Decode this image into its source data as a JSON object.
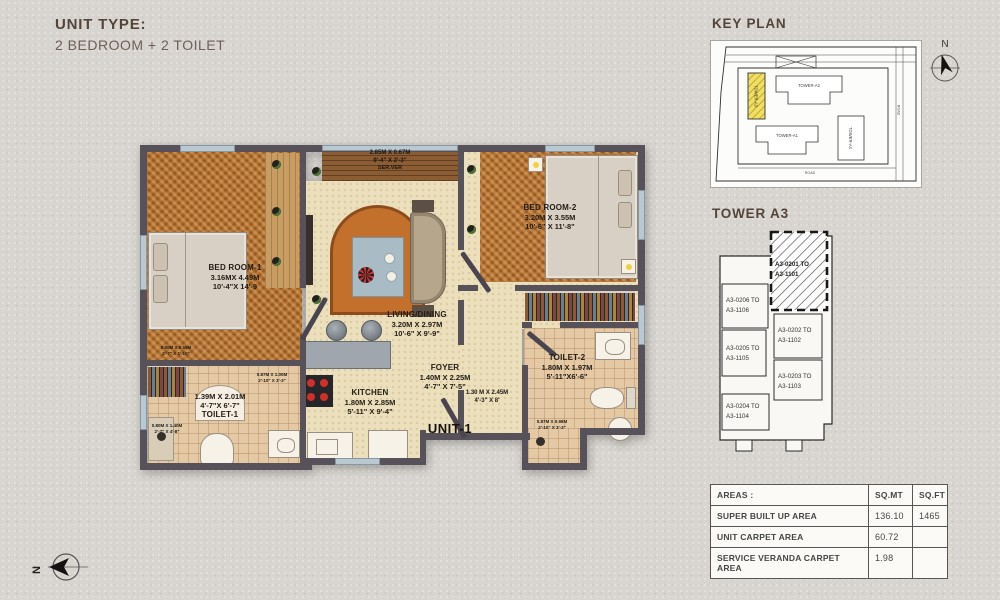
{
  "header": {
    "title": "UNIT TYPE:",
    "subtitle": "2 BEDROOM + 2 TOILET"
  },
  "plan": {
    "unit_label": "UNIT-1",
    "bedroom1": {
      "name": "BED ROOM-1",
      "m": "3.16MX 4.49M",
      "ft": "10'-4\"X 14'-9"
    },
    "bedroom2": {
      "name": "BED ROOM-2",
      "m": "3.20M X 3.55M",
      "ft": "10'-6\" X 11'-8\""
    },
    "living": {
      "name": "LIVING/DINING",
      "m": "3.20M X 2.97M",
      "ft": "10'-6\" X 9'-9\""
    },
    "foyer": {
      "name": "FOYER",
      "m": "1.40M X 2.25M",
      "ft": "4'-7\" X 7'-5\""
    },
    "kitchen": {
      "name": "KITCHEN",
      "m": "1.80M X 2.85M",
      "ft": "5'-11\" X 9'-4\""
    },
    "toilet1": {
      "name": "TOILET-1",
      "m": "1.39M X 2.01M",
      "ft": "4'-7\"X 6'-7\""
    },
    "toilet2": {
      "name": "TOILET-2",
      "m": "1.80M X 1.97M",
      "ft": "5'-11\"X6'-6\""
    },
    "veranda": {
      "name": "SER.VER",
      "m": "2.85M X 0.67M",
      "ft": "9'-4\" X 2'-3\""
    },
    "passage": {
      "m": "1.30 M X 2.45M",
      "ft": "4'-3\" X 8'"
    },
    "dim_a": {
      "m": "0.80M X 0.55M",
      "ft": "2'-7\" X 1'-10\""
    },
    "dim_b": {
      "m": "0.87M X 1.00M",
      "ft": "2'-10\" X 3'-3\""
    },
    "dim_c": {
      "m": "0.80M X 1.40M",
      "ft": "2'-7\" X 4'-8\""
    },
    "dim_e": {
      "m": "0.87M X 0.98M",
      "ft": "2'-10\" X 3'-3\""
    }
  },
  "key_plan": {
    "title": "KEY PLAN",
    "north": "N",
    "tower_a3": "TOWER-A3",
    "tower_a2": "TOWER-A2",
    "tower_a1": "TOWER-A1",
    "tower_a4": "TOWER-A4",
    "road": "ROAD"
  },
  "tower": {
    "title": "TOWER A3",
    "highlight": {
      "l1": "A3-0201 TO",
      "l2": "A3-1101"
    },
    "u206": {
      "l1": "A3-0206 TO",
      "l2": "A3-1106"
    },
    "u205": {
      "l1": "A3-0205 TO",
      "l2": "A3-1105"
    },
    "u204": {
      "l1": "A3-0204 TO",
      "l2": "A3-1104"
    },
    "u202": {
      "l1": "A3-0202 TO",
      "l2": "A3-1102"
    },
    "u203": {
      "l1": "A3-0203 TO",
      "l2": "A3-1103"
    }
  },
  "areas_table": {
    "col_label": "AREAS :",
    "col_sqmt": "SQ.MT",
    "col_sqft": "SQ.FT",
    "rows": [
      {
        "label": "SUPER BUILT UP AREA",
        "sqmt": "136.10",
        "sqft": "1465"
      },
      {
        "label": "UNIT CARPET AREA",
        "sqmt": "60.72",
        "sqft": ""
      },
      {
        "label": "SERVICE VERANDA CARPET AREA",
        "sqmt": "1.98",
        "sqft": ""
      }
    ]
  },
  "compass": {
    "north": "N"
  },
  "colors": {
    "page_bg": "#d8d5d0",
    "wall": "#57525a",
    "wood_floor": "#b5712f",
    "highlight_yellow": "#f0df63"
  }
}
